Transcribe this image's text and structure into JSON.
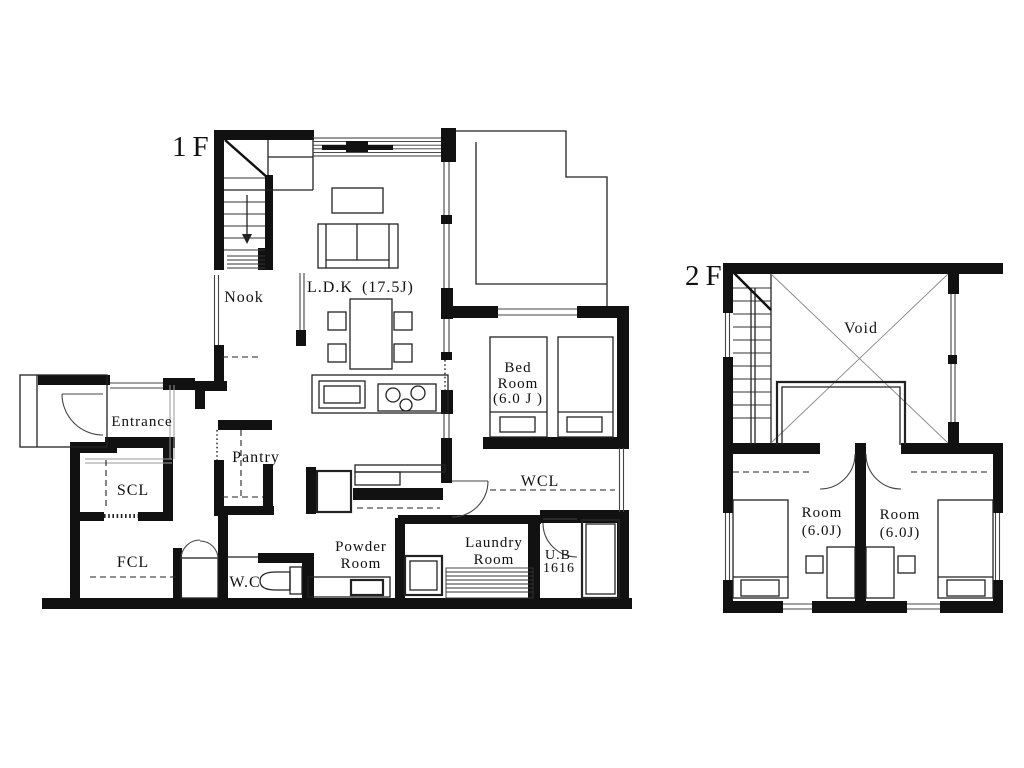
{
  "colors": {
    "wall": "#111111",
    "line": "#222222",
    "window": "#444444",
    "background": "#ffffff"
  },
  "floor1": {
    "label": "1F",
    "ldk": {
      "name": "L.D.K",
      "size": "(17.5J)"
    },
    "rooms": {
      "nook": "Nook",
      "entrance": "Entrance",
      "scl": "SCL",
      "fcl": "FCL",
      "pantry": "Pantry",
      "wc": "W.C",
      "powder": [
        "Powder",
        "Room"
      ],
      "laundry": [
        "Laundry",
        "Room"
      ],
      "unit_bath": [
        "U.B",
        "1616"
      ],
      "wcl": "WCL",
      "bedroom": [
        "Bed",
        "Room",
        "(6.0 J )"
      ]
    }
  },
  "floor2": {
    "label": "2F",
    "rooms": {
      "void": "Void",
      "room_left": [
        "Room",
        "(6.0J)"
      ],
      "room_right": [
        "Room",
        "(6.0J)"
      ]
    }
  }
}
